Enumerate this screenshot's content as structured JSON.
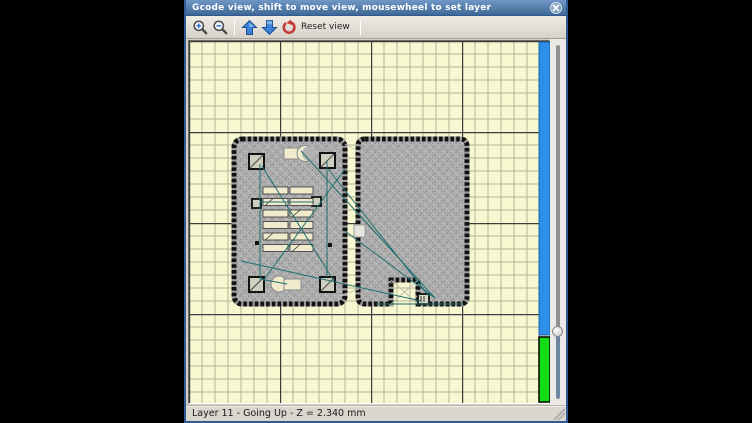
{
  "window": {
    "title": "Gcode view, shift to move view, mousewheel to set layer",
    "close_glyph": "✕"
  },
  "toolbar": {
    "reset_label": "Reset view",
    "buttons": [
      {
        "name": "zoom-in",
        "icon": "magnifier-plus"
      },
      {
        "name": "zoom-out",
        "icon": "magnifier-minus"
      },
      {
        "name": "layer-up",
        "icon": "arrow-up-blue"
      },
      {
        "name": "layer-down",
        "icon": "arrow-down-blue"
      },
      {
        "name": "reset-view",
        "icon": "red-undo-arrow"
      }
    ]
  },
  "statusbar": {
    "text": "Layer 11 - Going Up - Z = 2.340 mm",
    "layer": 11,
    "direction": "Going Up",
    "z_mm": "2.340"
  },
  "canvas": {
    "layer_bar": {
      "above_color": "#2d8fe8",
      "below_color": "#14dd14",
      "split_ratio": 0.81
    },
    "grid": {
      "minor_px": 13.0,
      "major_px": 91.0
    }
  },
  "colors": {
    "frame_blue": "#2f5a94",
    "titlebar_blue": "#49729f",
    "canvas_bg": "#f8f8d0",
    "grid_minor": "#b4b49c",
    "grid_major": "#3c3c3c",
    "infill_gray": "#b2b2b2",
    "perimeter_black": "#111111",
    "travel_teal": "#1e6f6f"
  }
}
